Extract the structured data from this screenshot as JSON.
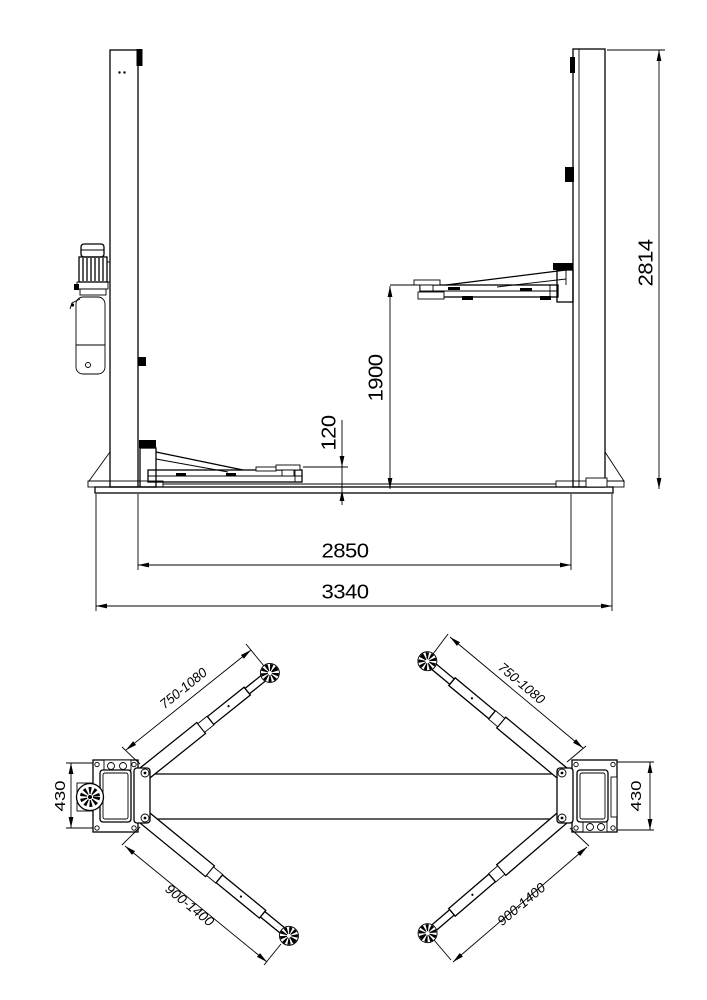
{
  "colors": {
    "line": "#000000",
    "background": "#ffffff"
  },
  "front_view": {
    "dims": {
      "overall_height": "2814",
      "lift_height": "1900",
      "pad_min_height": "120",
      "column_clearance": "2850",
      "overall_width": "3340"
    }
  },
  "plan_view": {
    "dims": {
      "front_arm_reach": "750-1080",
      "rear_arm_reach": "900-1400",
      "plate_depth": "430"
    }
  }
}
